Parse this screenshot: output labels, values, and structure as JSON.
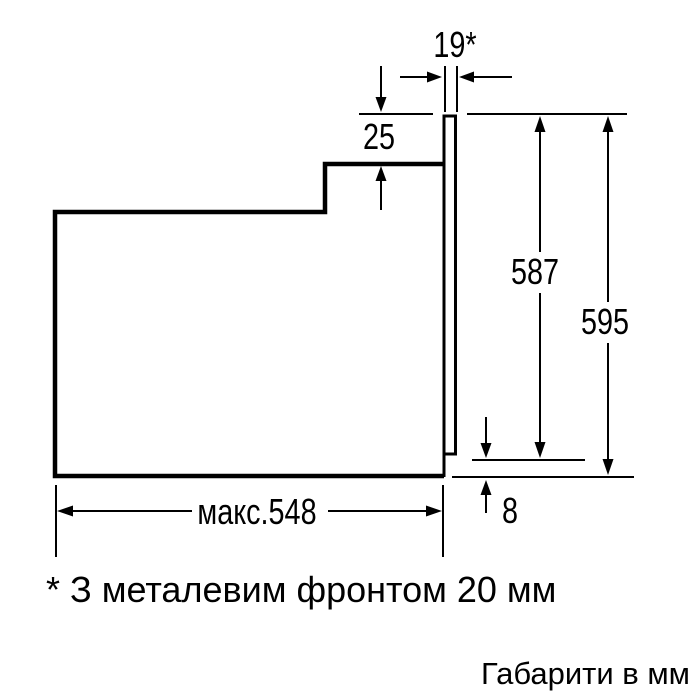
{
  "colors": {
    "background": "#ffffff",
    "line": "#000000",
    "text": "#000000"
  },
  "diagram": {
    "dimensions": {
      "front_thickness": "19*",
      "top_recess": "25",
      "inner_height": "587",
      "total_height": "595",
      "bottom_offset": "8",
      "max_depth": "макс.548"
    },
    "footnote": "* З металевим фронтом 20 мм",
    "units_caption": "Габарити в мм"
  }
}
